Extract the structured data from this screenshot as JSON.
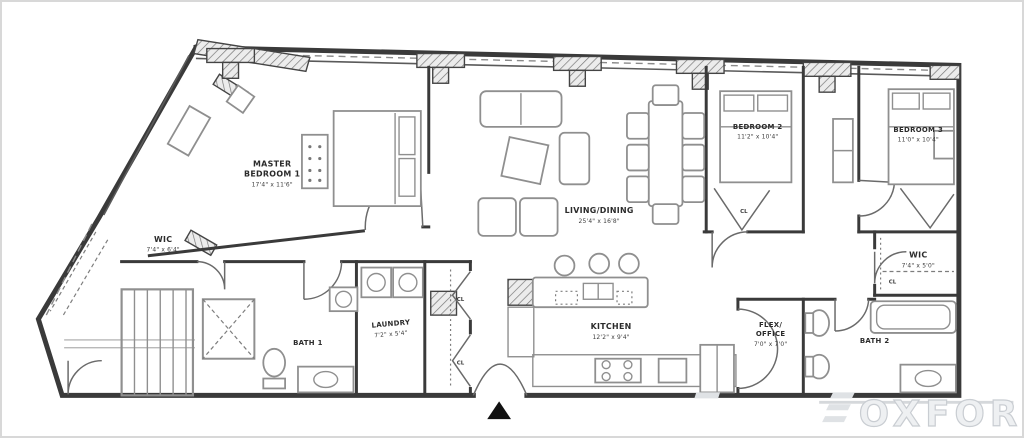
{
  "rooms": {
    "master_bedroom": {
      "line1": "MASTER",
      "line2": "BEDROOM 1",
      "dims": "17'4\" x 11'6\""
    },
    "wic_left": {
      "line1": "WIC",
      "dims": "7'4\" x 6'4\""
    },
    "bath_1": {
      "line1": "BATH 1"
    },
    "laundry": {
      "line1": "LAUNDRY",
      "dims": "7'2\" x 5'4\""
    },
    "living_dining": {
      "line1": "LIVING/DINING",
      "dims": "25'4\" x 16'8\""
    },
    "kitchen": {
      "line1": "KITCHEN",
      "dims": "12'2\" x 9'4\""
    },
    "flex_office": {
      "line1": "FLEX/",
      "line2": "OFFICE",
      "dims": "7'0\" x 7'0\""
    },
    "bedroom_2": {
      "line1": "BEDROOM 2",
      "dims": "11'2\" x 10'4\""
    },
    "bedroom_3": {
      "line1": "BEDROOM 3",
      "dims": "11'0\" x 10'4\""
    },
    "wic_right": {
      "line1": "WIC",
      "dims": "7'4\" x 5'0\""
    },
    "bath_2": {
      "line1": "BATH 2"
    }
  },
  "labels": {
    "cl": "CL"
  },
  "watermark": {
    "text": "OXFORD"
  },
  "icons": {
    "entry_marker": "triangle-up",
    "watermark_logo": "three-bars"
  },
  "colors": {
    "wall": "#3a3a3a",
    "furniture": "#8f8f8f",
    "label": "#2b2b2b",
    "watermark": "#c9cdd2",
    "entry_marker": "#111111",
    "frame_border": "#d8d8d8"
  }
}
